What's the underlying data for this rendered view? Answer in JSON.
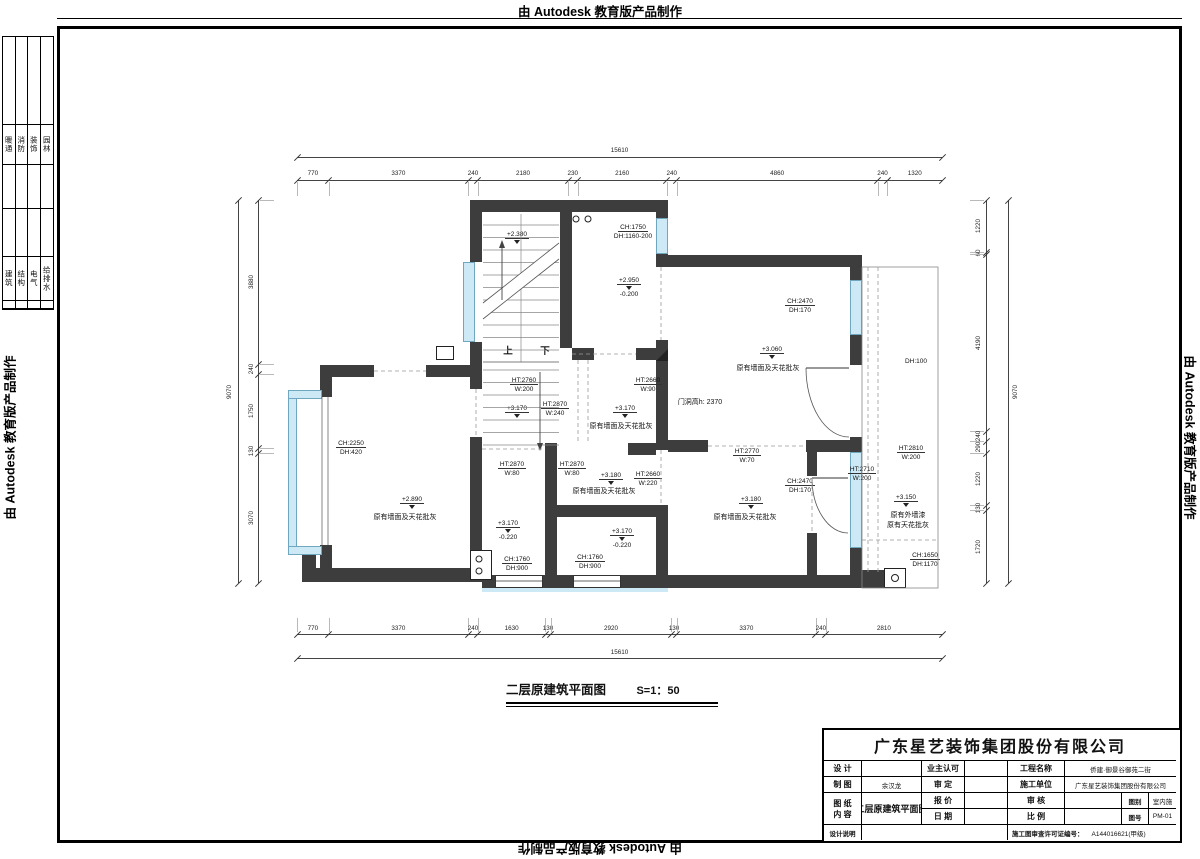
{
  "watermark": {
    "text": "由 Autodesk 教育版产品制作"
  },
  "margin_table": {
    "group1": [
      "暖通",
      "消防",
      "装饰",
      "园林"
    ],
    "group2": [
      "建筑",
      "结构",
      "电气",
      "给排水"
    ]
  },
  "plan_title": {
    "text": "二层原建筑平面图",
    "scale": "S=1：50"
  },
  "dimensions": {
    "top": {
      "total": "15610",
      "segments": [
        "770",
        "3370",
        "240",
        "2180",
        "230",
        "2160",
        "240",
        "4860",
        "240",
        "1320"
      ]
    },
    "bottom": {
      "total": "15610",
      "segments": [
        "770",
        "3370",
        "240",
        "1630",
        "130",
        "2920",
        "130",
        "3370",
        "240",
        "2810"
      ]
    },
    "left": {
      "total": "9070",
      "segments": [
        "3880",
        "240",
        "1750",
        "130",
        "3070"
      ]
    },
    "right": {
      "total": "9070",
      "segments": [
        "1220",
        "60",
        "4190",
        "240",
        "290",
        "1220",
        "130",
        "1720"
      ]
    }
  },
  "plan": {
    "annotations": [
      {
        "t": "+2.380",
        "x": 517,
        "y": 231,
        "c": "lvlu"
      },
      {
        "t": "上",
        "x": 508,
        "y": 346,
        "c": "big"
      },
      {
        "t": "下",
        "x": 545,
        "y": 346,
        "c": "big"
      },
      {
        "t": "CH:1750",
        "x": 633,
        "y": 224,
        "u": 1
      },
      {
        "t": "DH:1160-200",
        "x": 633,
        "y": 233
      },
      {
        "t": "+2.950",
        "x": 629,
        "y": 277,
        "c": "lvlu"
      },
      {
        "t": "-0.200",
        "x": 629,
        "y": 291
      },
      {
        "t": "HT:2760",
        "x": 524,
        "y": 377,
        "u": 1
      },
      {
        "t": "W:200",
        "x": 524,
        "y": 386
      },
      {
        "t": "HT:2870",
        "x": 555,
        "y": 401,
        "u": 1
      },
      {
        "t": "W:240",
        "x": 555,
        "y": 410
      },
      {
        "t": "HT:2660",
        "x": 648,
        "y": 377,
        "u": 1
      },
      {
        "t": "W:90",
        "x": 648,
        "y": 386
      },
      {
        "t": "+3.170",
        "x": 517,
        "y": 405,
        "c": "lvlu"
      },
      {
        "t": "+3.170",
        "x": 625,
        "y": 405,
        "c": "lvlu"
      },
      {
        "t": "原有墙面及天花批灰",
        "x": 621,
        "y": 423,
        "c": "cn"
      },
      {
        "t": "门洞高h: 2370",
        "x": 700,
        "y": 399,
        "c": "cn"
      },
      {
        "t": "CH:2470",
        "x": 800,
        "y": 298,
        "u": 1
      },
      {
        "t": "DH:170",
        "x": 800,
        "y": 307
      },
      {
        "t": "+3.060",
        "x": 772,
        "y": 346,
        "c": "lvlu"
      },
      {
        "t": "原有墙面及天花批灰",
        "x": 768,
        "y": 365,
        "c": "cn"
      },
      {
        "t": "CH:2470",
        "x": 800,
        "y": 478,
        "u": 1
      },
      {
        "t": "DH:170",
        "x": 800,
        "y": 487
      },
      {
        "t": "DH:100",
        "x": 916,
        "y": 358
      },
      {
        "t": "CH:2250",
        "x": 351,
        "y": 440,
        "u": 1
      },
      {
        "t": "DH:420",
        "x": 351,
        "y": 449
      },
      {
        "t": "+2.890",
        "x": 412,
        "y": 496,
        "c": "lvlu"
      },
      {
        "t": "原有墙面及天花批灰",
        "x": 405,
        "y": 514,
        "c": "cn"
      },
      {
        "t": "HT:2870",
        "x": 512,
        "y": 461,
        "u": 1
      },
      {
        "t": "W:80",
        "x": 512,
        "y": 470
      },
      {
        "t": "HT:2870",
        "x": 572,
        "y": 461,
        "u": 1
      },
      {
        "t": "W:80",
        "x": 572,
        "y": 470
      },
      {
        "t": "+3.180",
        "x": 611,
        "y": 472,
        "c": "lvlu"
      },
      {
        "t": "原有墙面及天花批灰",
        "x": 604,
        "y": 488,
        "c": "cn"
      },
      {
        "t": "HT:2660",
        "x": 648,
        "y": 471,
        "u": 1
      },
      {
        "t": "W:220",
        "x": 648,
        "y": 480
      },
      {
        "t": "+3.170",
        "x": 508,
        "y": 520,
        "c": "lvlu"
      },
      {
        "t": "-0.220",
        "x": 508,
        "y": 534
      },
      {
        "t": "+3.170",
        "x": 622,
        "y": 528,
        "c": "lvlu"
      },
      {
        "t": "-0.220",
        "x": 622,
        "y": 542
      },
      {
        "t": "CH:1760",
        "x": 517,
        "y": 556,
        "u": 1
      },
      {
        "t": "DH:900",
        "x": 517,
        "y": 565
      },
      {
        "t": "CH:1760",
        "x": 590,
        "y": 554,
        "u": 1
      },
      {
        "t": "DH:900",
        "x": 590,
        "y": 563
      },
      {
        "t": "HT:2770",
        "x": 747,
        "y": 448,
        "u": 1
      },
      {
        "t": "W:70",
        "x": 747,
        "y": 457
      },
      {
        "t": "+3.180",
        "x": 751,
        "y": 496,
        "c": "lvlu"
      },
      {
        "t": "原有墙面及天花批灰",
        "x": 745,
        "y": 514,
        "c": "cn"
      },
      {
        "t": "HT:2810",
        "x": 911,
        "y": 445,
        "u": 1
      },
      {
        "t": "W:200",
        "x": 911,
        "y": 454
      },
      {
        "t": "HT:2710",
        "x": 862,
        "y": 466,
        "u": 1
      },
      {
        "t": "W:200",
        "x": 862,
        "y": 475
      },
      {
        "t": "+3.150",
        "x": 906,
        "y": 494,
        "c": "lvlu"
      },
      {
        "t": "原有外墙漆",
        "x": 908,
        "y": 512,
        "c": "cn"
      },
      {
        "t": "原有天花批灰",
        "x": 908,
        "y": 522,
        "c": "cn"
      },
      {
        "t": "CH:1650",
        "x": 925,
        "y": 552,
        "u": 1
      },
      {
        "t": "DH:1170",
        "x": 925,
        "y": 561
      }
    ]
  },
  "title_block": {
    "company": "广东星艺装饰集团股份有限公司",
    "labels": {
      "design": "设 计",
      "owner": "业主认可",
      "draft": "制 图",
      "approve": "审 定",
      "quote": "报 价",
      "check": "审 核",
      "date": "日 期",
      "scale": "比 例",
      "notes": "设计说明",
      "project": "工程名称",
      "builder": "施工单位",
      "sheet1": "图 纸",
      "sheet2": "内 容",
      "category": "图别",
      "number": "图号",
      "permit": "施工图审查许可证编号："
    },
    "values": {
      "drafter": "余汉龙",
      "project": "侨建·御景谷御苑二街",
      "builder": "广东星艺装饰集团股份有限公司",
      "content": "二层原建筑平面图",
      "category": "室内施",
      "number": "PM-01",
      "permit": "A144016621(甲级)"
    }
  }
}
